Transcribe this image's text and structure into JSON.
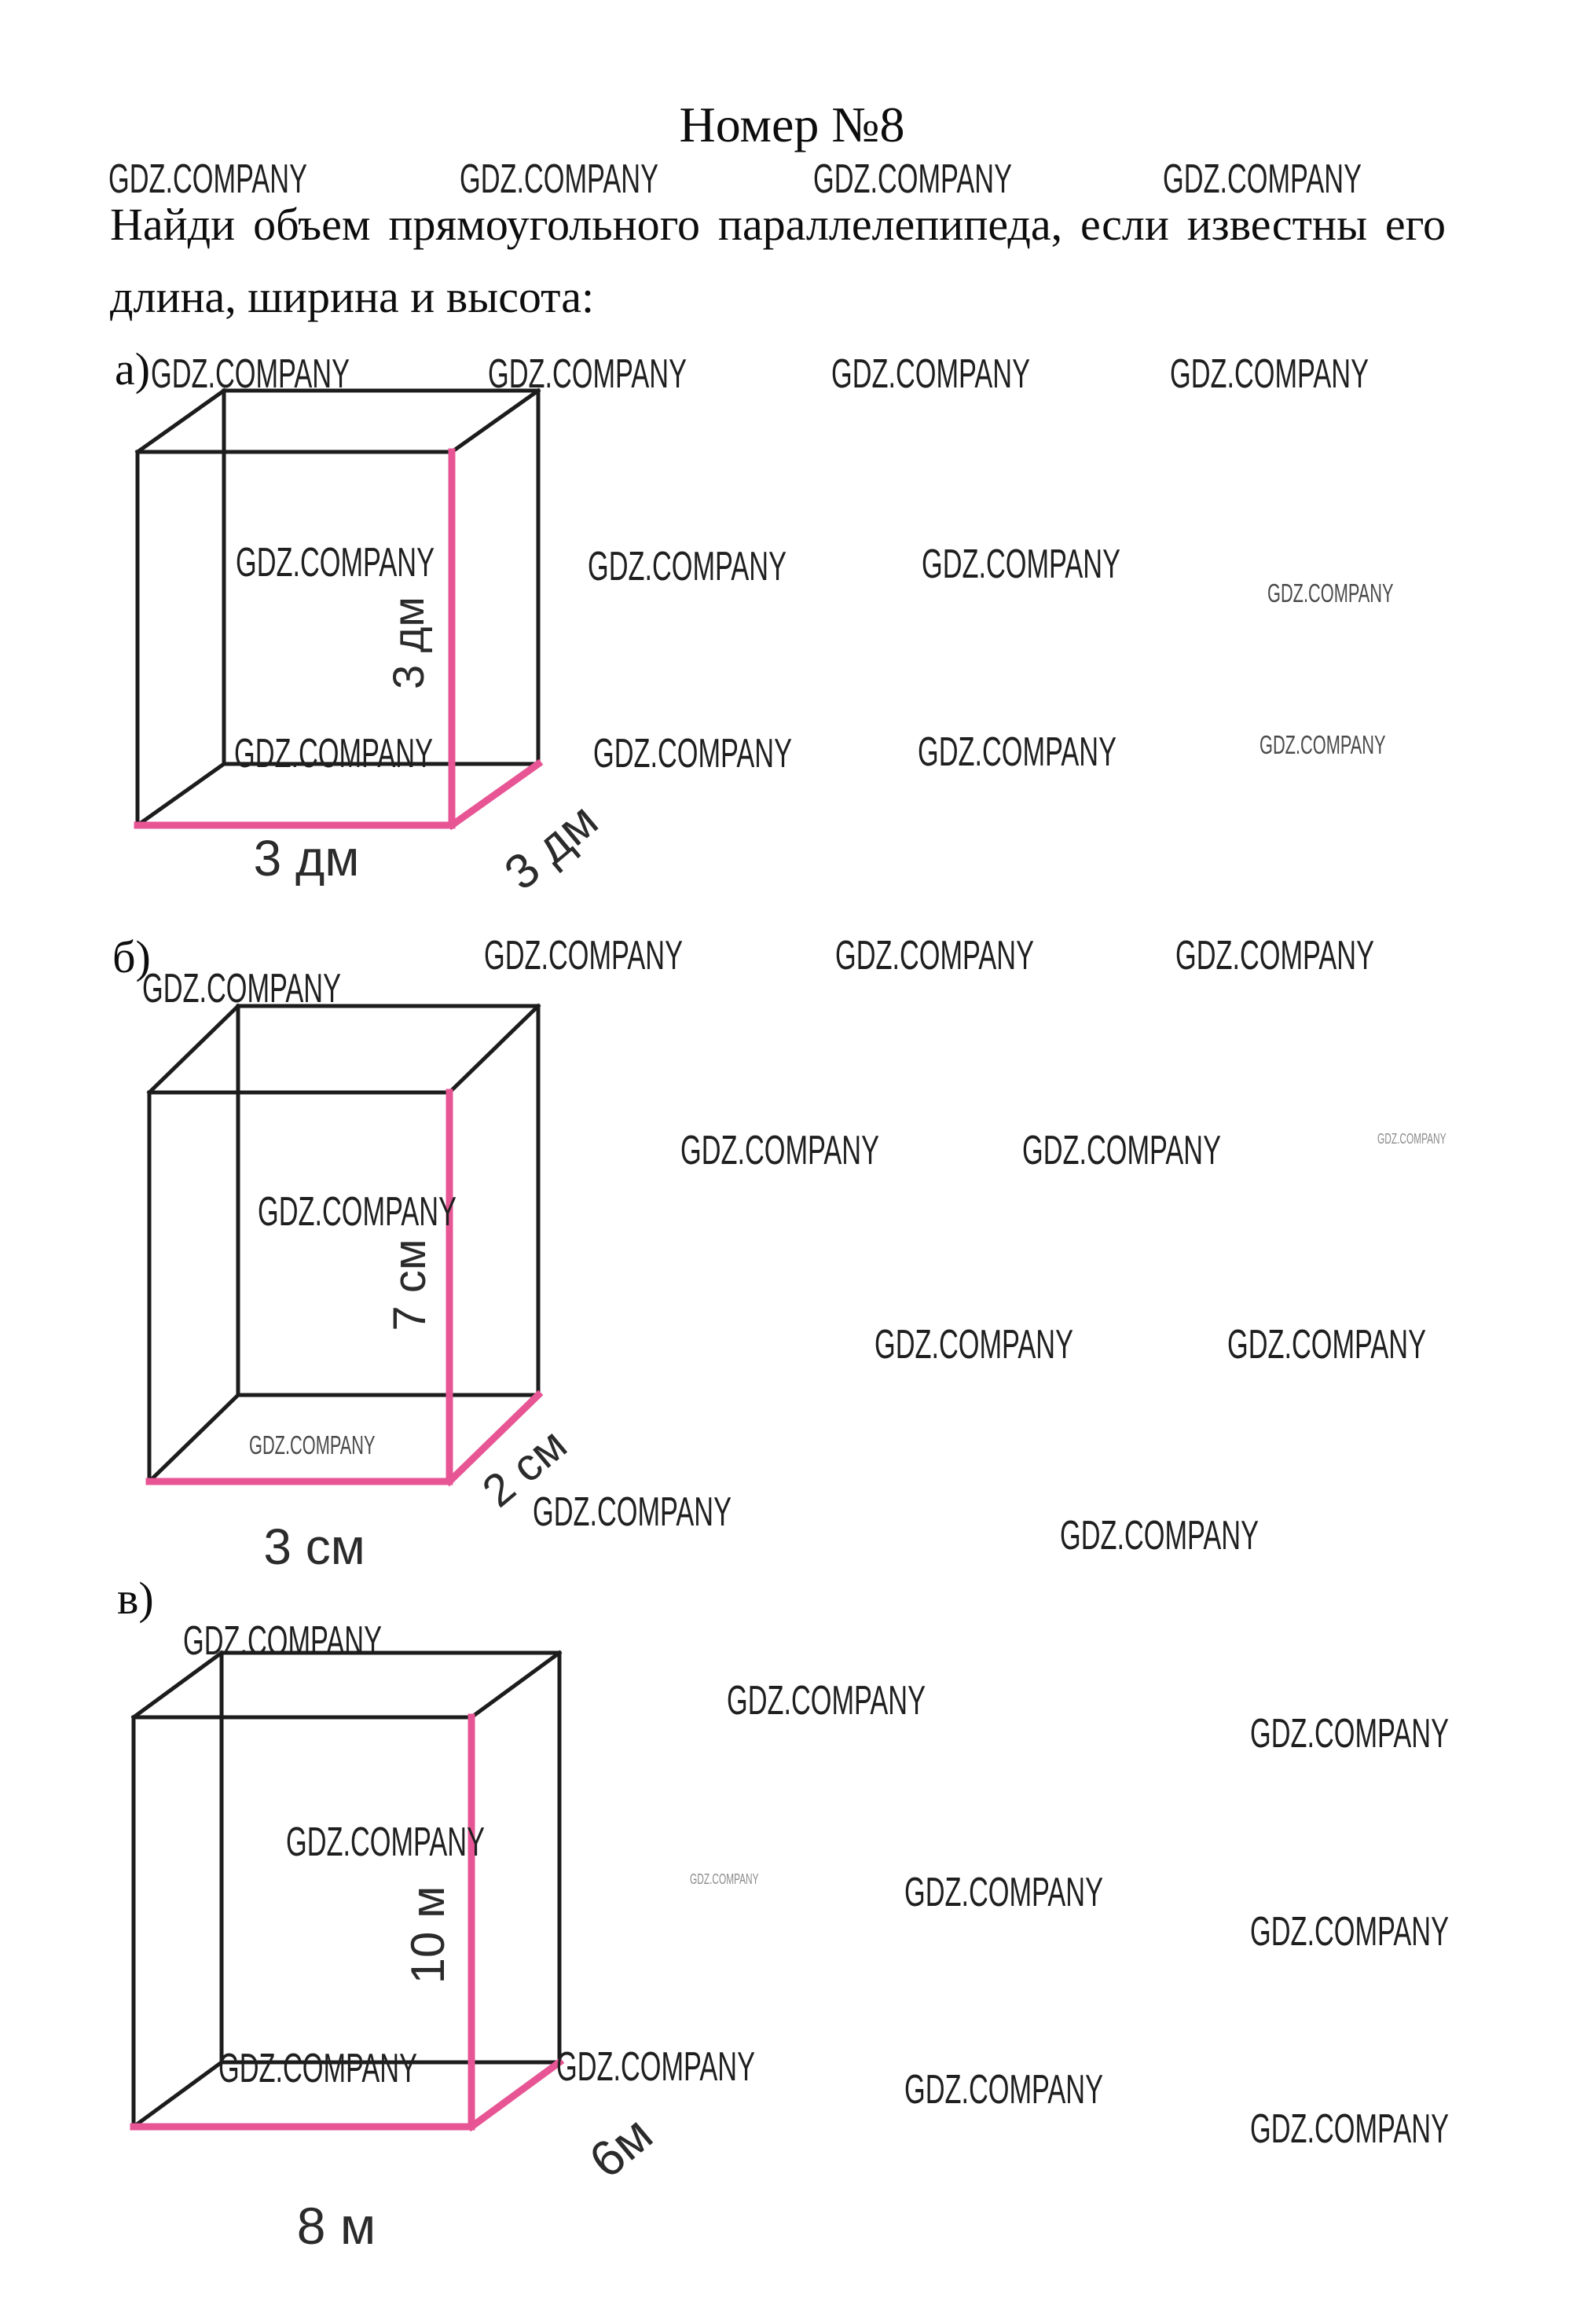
{
  "page": {
    "title": "Номер №8",
    "watermark": "GDZ.COMPANY",
    "problem_line1": "Найди объем прямоугольного параллелепипеда, если известны его",
    "problem_line2": "длина, ширина и высота:"
  },
  "figures": [
    {
      "label": "а)",
      "height": "3 дм",
      "length": "3 дм",
      "depth": "3 дм"
    },
    {
      "label": "б)",
      "height": "7 см",
      "length": "3 см",
      "depth": "2 см"
    },
    {
      "label": "в)",
      "height": "10 м",
      "length": "8 м",
      "depth": "6м"
    }
  ],
  "colors": {
    "edge": "#1c1c1c",
    "highlight": "#e75594",
    "text": "#0d0d0d"
  }
}
